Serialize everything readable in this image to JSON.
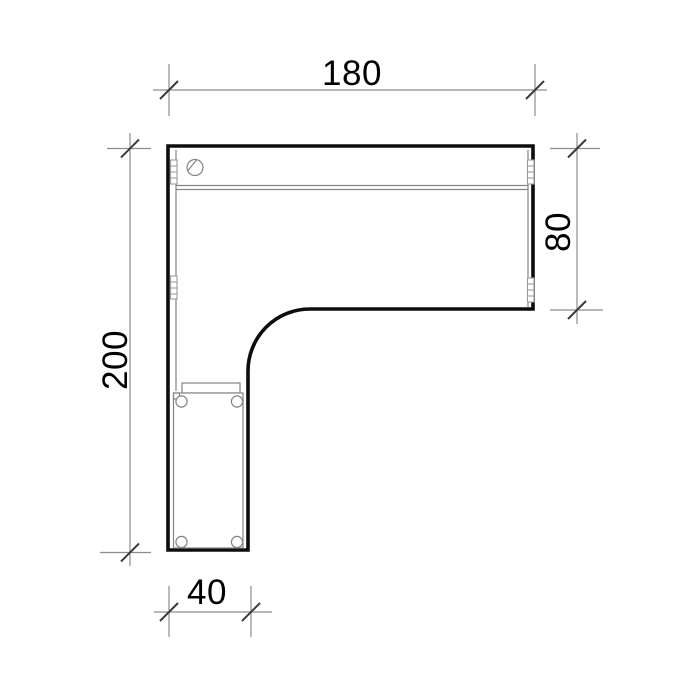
{
  "drawing": {
    "dimensions": {
      "top": {
        "label": "180"
      },
      "left": {
        "label": "200"
      },
      "right": {
        "label": "80"
      },
      "bottom": {
        "label": "40"
      }
    },
    "colors": {
      "background": "#ffffff",
      "outline": "#0d0d0d",
      "detail_line": "#848484",
      "bracket_line": "#9a9a9a",
      "dimension_line": "#8c8c8c",
      "tick": "#3c3c3c",
      "text": "#000000"
    }
  }
}
